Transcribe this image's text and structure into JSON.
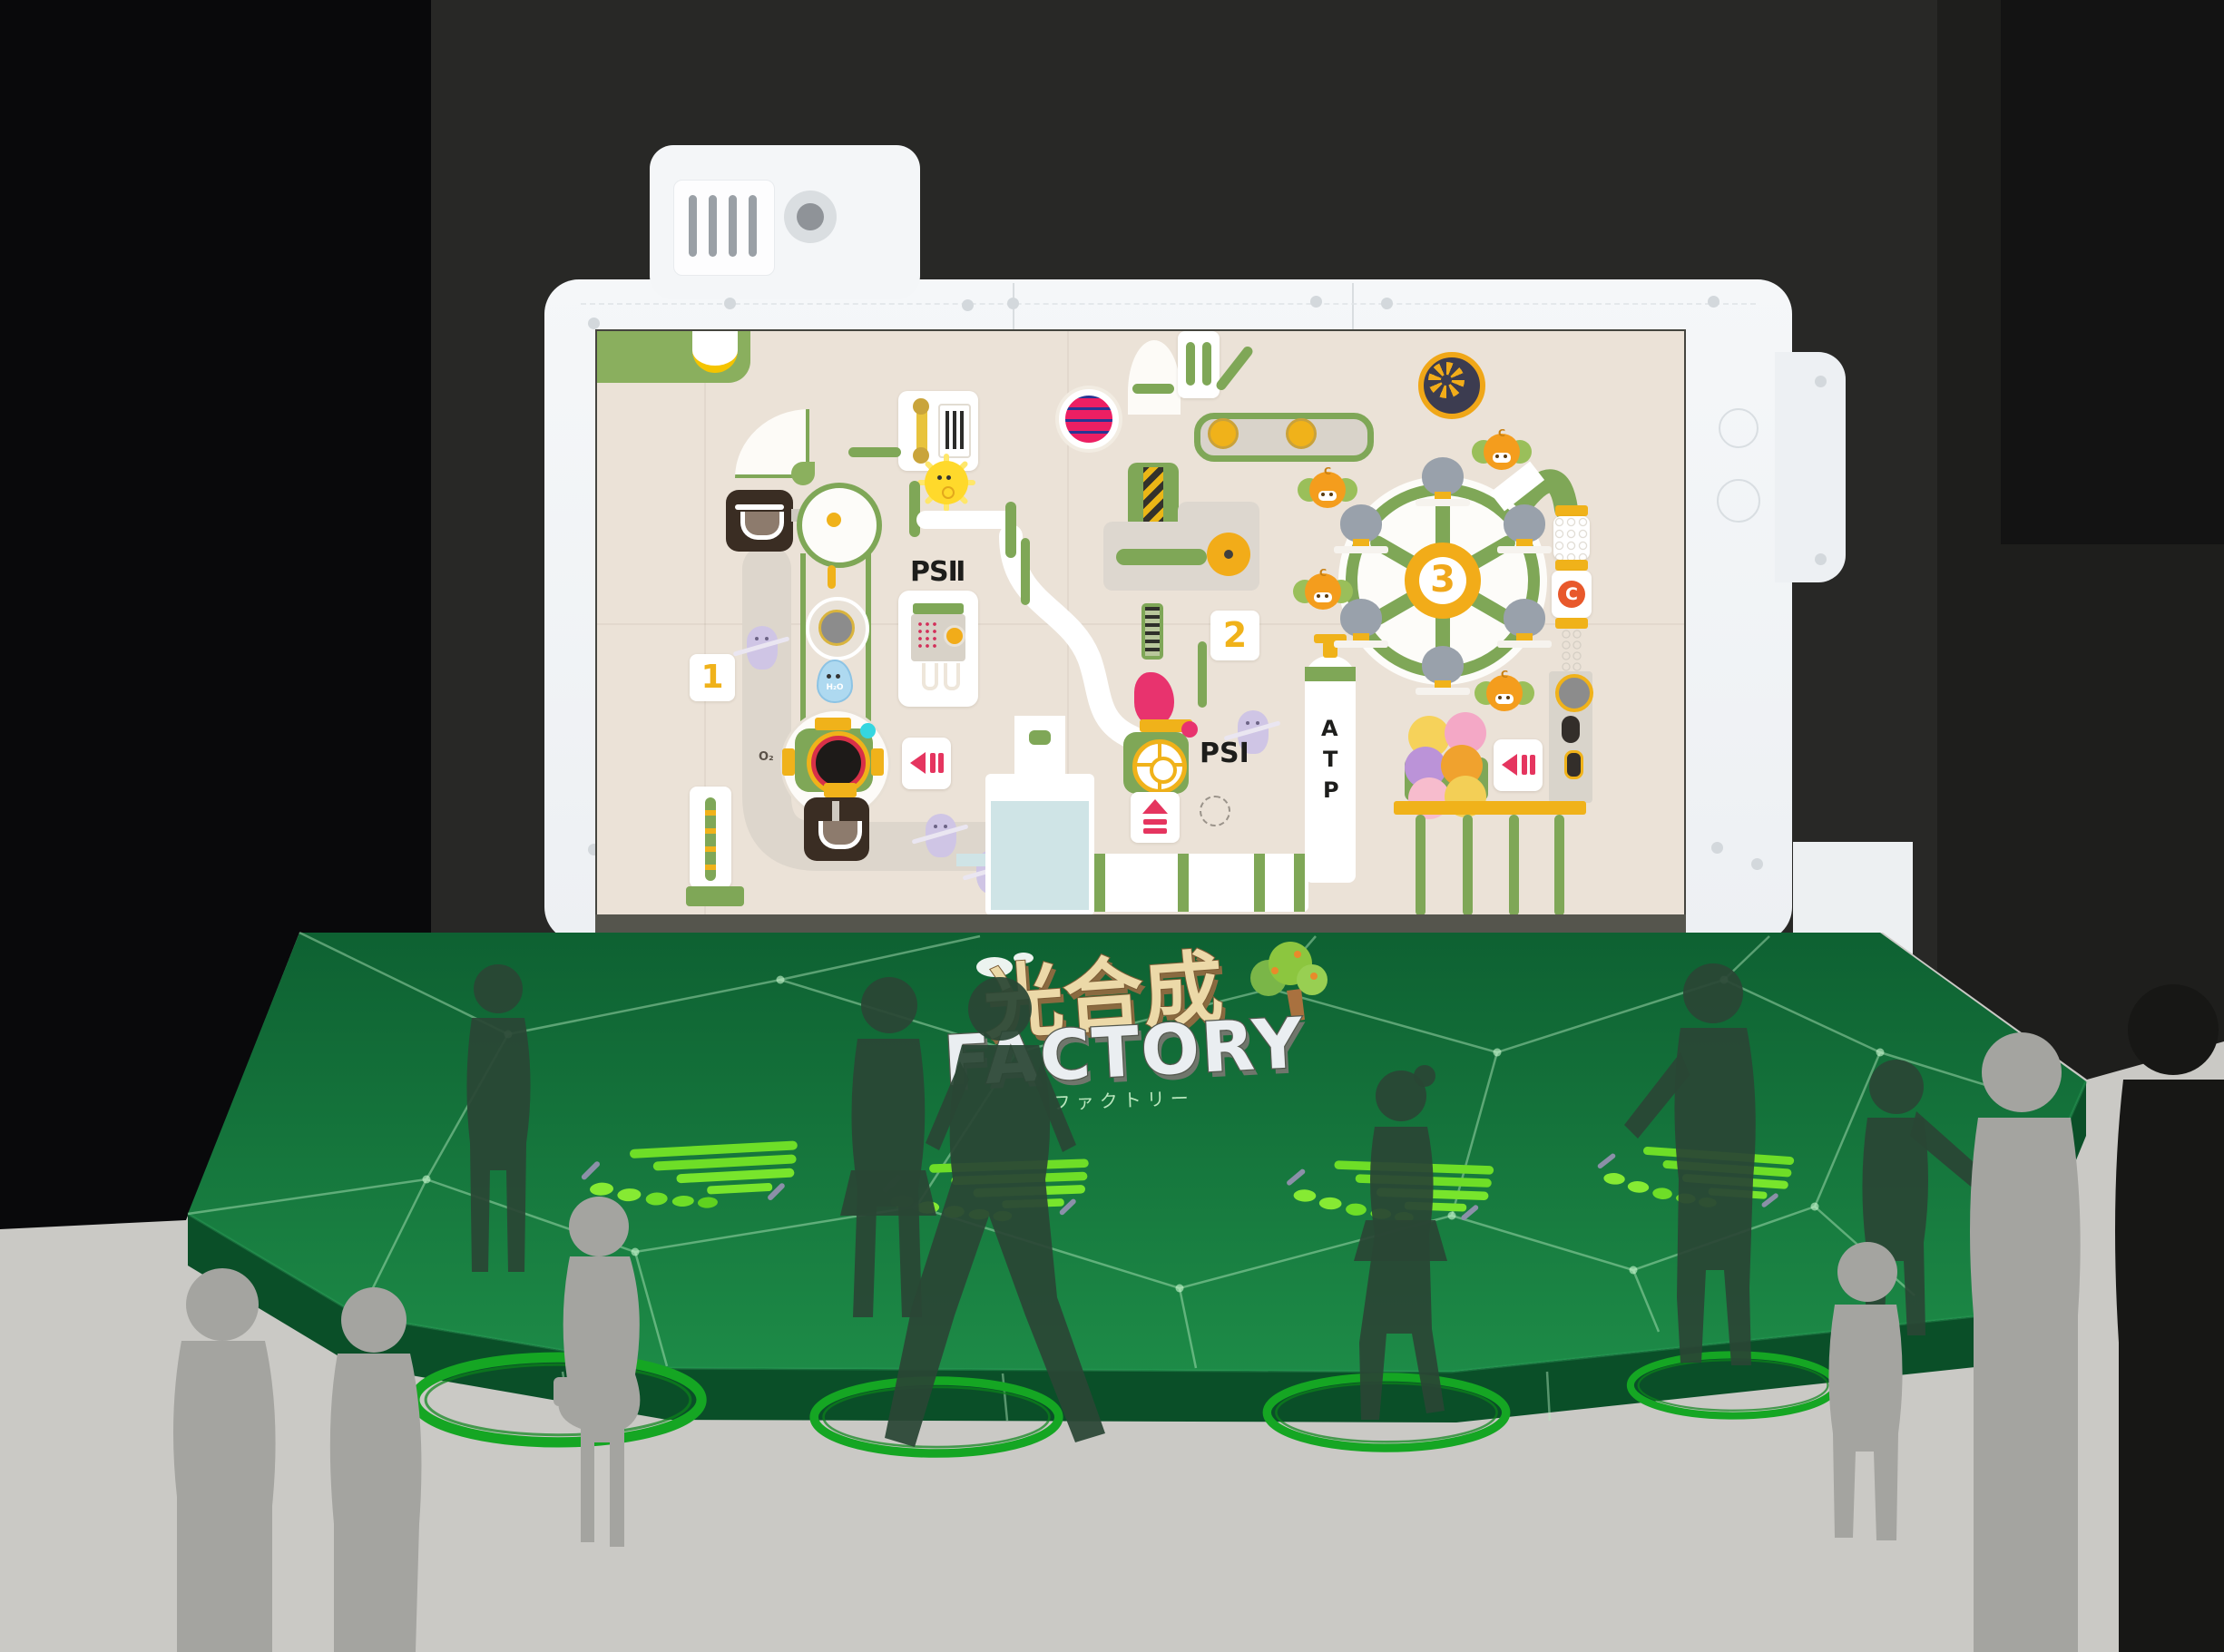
{
  "scene": {
    "setting": "dark exhibition room with projection stage",
    "logo": {
      "kanji": "光合成",
      "latin": "FACTORY",
      "katakana": "ファクトリー"
    }
  },
  "screen_game": {
    "labels": {
      "ps2": "PSⅡ",
      "ps1": "PSI",
      "atp_letters": [
        "A",
        "T",
        "P"
      ],
      "station_1": "1",
      "station_2": "2",
      "station_3": "3",
      "h2o": "H₂O",
      "o2": "O₂",
      "carbon": "C"
    },
    "counts": {
      "co2_characters": 4,
      "wheel_riders": 6,
      "ghost_characters": 4,
      "pause_buttons": 2
    }
  },
  "stage": {
    "step_markers": 4,
    "floor_rings": 4,
    "silhouettes_on_stage": 6,
    "silhouettes_on_floor": 6
  },
  "palette": {
    "frame_white": "#f2f4f6",
    "screen_cream": "#ebe2d7",
    "machine_green": "#7fa757",
    "accent_yellow": "#f0b21a",
    "accent_pink": "#e5355f",
    "lever_crimson": "#e8336e",
    "stage_green_top": "#126c36",
    "stage_green_front": "#0a4f28",
    "marker_green": "#6ede27",
    "ring_green": "#15a623",
    "floor_gray": "#cbcac6",
    "wall_dark": "#282826",
    "water_blue": "#cfe4e6",
    "ghost_purple": "#cfc5e5",
    "co2_orange": "#f49d1d",
    "rider_gray": "#99a1ab",
    "dark_brown": "#3a2d23"
  }
}
